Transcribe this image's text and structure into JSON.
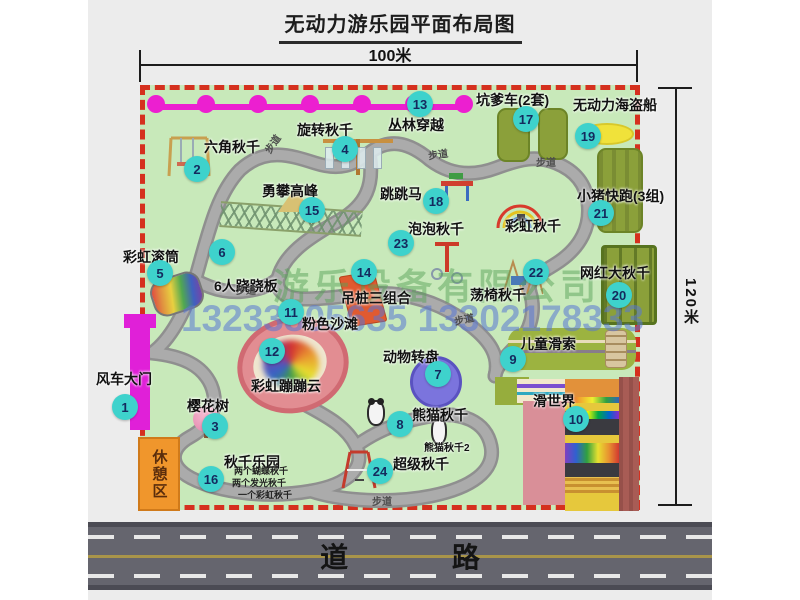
{
  "title": "无动力游乐园平面布局图",
  "dimensions": {
    "width": "100米",
    "height": "120米"
  },
  "road": {
    "label": "道 路"
  },
  "rest_area": {
    "label": "休憩区"
  },
  "watermark": {
    "company": "游乐设备有限公司",
    "phone": "13233805635 13302178333"
  },
  "walkway_label_text": "步道",
  "walkway_labels": [
    {
      "x": 174,
      "y": 136,
      "r": -55
    },
    {
      "x": 340,
      "y": 146,
      "r": -8
    },
    {
      "x": 448,
      "y": 154,
      "r": 0
    },
    {
      "x": 148,
      "y": 282,
      "r": 0
    },
    {
      "x": 366,
      "y": 311,
      "r": -12
    },
    {
      "x": 284,
      "y": 493,
      "r": 0
    }
  ],
  "attractions": [
    {
      "num": 1,
      "name": "风车大门",
      "cx": 37,
      "cy": 407,
      "lx": 8,
      "ly": 369
    },
    {
      "num": 2,
      "name": "六角秋千",
      "cx": 109,
      "cy": 169,
      "lx": 116,
      "ly": 137
    },
    {
      "num": 3,
      "name": "樱花树",
      "cx": 127,
      "cy": 426,
      "lx": 99,
      "ly": 396
    },
    {
      "num": 4,
      "name": "旋转秋千",
      "cx": 257,
      "cy": 149,
      "lx": 209,
      "ly": 120
    },
    {
      "num": 5,
      "name": "彩虹滚筒",
      "cx": 72,
      "cy": 273,
      "lx": 35,
      "ly": 247
    },
    {
      "num": 6,
      "name": "6人跷跷板",
      "cx": 134,
      "cy": 252,
      "lx": 126,
      "ly": 276
    },
    {
      "num": 7,
      "name": "动物转盘",
      "cx": 350,
      "cy": 374,
      "lx": 295,
      "ly": 347
    },
    {
      "num": 8,
      "name": "熊猫秋千",
      "cx": 312,
      "cy": 424,
      "lx": 324,
      "ly": 405
    },
    {
      "num": 9,
      "name": "儿童滑索",
      "cx": 425,
      "cy": 359,
      "lx": 432,
      "ly": 334
    },
    {
      "num": 10,
      "name": "滑世界",
      "cx": 488,
      "cy": 419,
      "lx": 445,
      "ly": 391
    },
    {
      "num": 11,
      "name": "粉色沙滩",
      "cx": 203,
      "cy": 312,
      "lx": 214,
      "ly": 314
    },
    {
      "num": 12,
      "name": "彩虹蹦蹦云",
      "cx": 184,
      "cy": 351,
      "lx": 163,
      "ly": 376
    },
    {
      "num": 13,
      "name": "丛林穿越",
      "cx": 332,
      "cy": 104,
      "lx": 300,
      "ly": 115
    },
    {
      "num": 14,
      "name": "吊桩三组合",
      "cx": 276,
      "cy": 272,
      "lx": 253,
      "ly": 288
    },
    {
      "num": 15,
      "name": "勇攀高峰",
      "cx": 224,
      "cy": 210,
      "lx": 174,
      "ly": 181
    },
    {
      "num": 16,
      "name": "秋千乐园",
      "cx": 123,
      "cy": 479,
      "lx": 136,
      "ly": 452
    },
    {
      "num": 17,
      "name": "坑爹车(2套)",
      "cx": 438,
      "cy": 119,
      "lx": 388,
      "ly": 90
    },
    {
      "num": 18,
      "name": "跳跳马",
      "cx": 348,
      "cy": 201,
      "lx": 292,
      "ly": 184
    },
    {
      "num": 19,
      "name": "无动力海盗船",
      "cx": 500,
      "cy": 136,
      "lx": 485,
      "ly": 95
    },
    {
      "num": 20,
      "name": "网红大秋千",
      "cx": 531,
      "cy": 295,
      "lx": 492,
      "ly": 263
    },
    {
      "num": 21,
      "name": "小猪快跑(3组)",
      "cx": 513,
      "cy": 213,
      "lx": 489,
      "ly": 186
    },
    {
      "num": 22,
      "name": "荡椅秋千",
      "cx": 448,
      "cy": 272,
      "lx": 382,
      "ly": 285
    },
    {
      "num": 23,
      "name": "泡泡秋千",
      "cx": 313,
      "cy": 243,
      "lx": 320,
      "ly": 219
    },
    {
      "num": 24,
      "name": "超级秋千",
      "cx": 292,
      "cy": 471,
      "lx": 305,
      "ly": 454
    }
  ],
  "extra_labels": [
    {
      "text": "彩虹秋千",
      "x": 417,
      "y": 216,
      "small": false
    },
    {
      "text": "熊猫秋千2",
      "x": 336,
      "y": 439,
      "small": true
    }
  ],
  "swing_park_notes": [
    {
      "text": "两个蝴蝶秋千",
      "x": 146,
      "y": 464
    },
    {
      "text": "两个发光秋千",
      "x": 144,
      "y": 476
    },
    {
      "text": "一个彩虹秋千",
      "x": 150,
      "y": 488
    }
  ]
}
